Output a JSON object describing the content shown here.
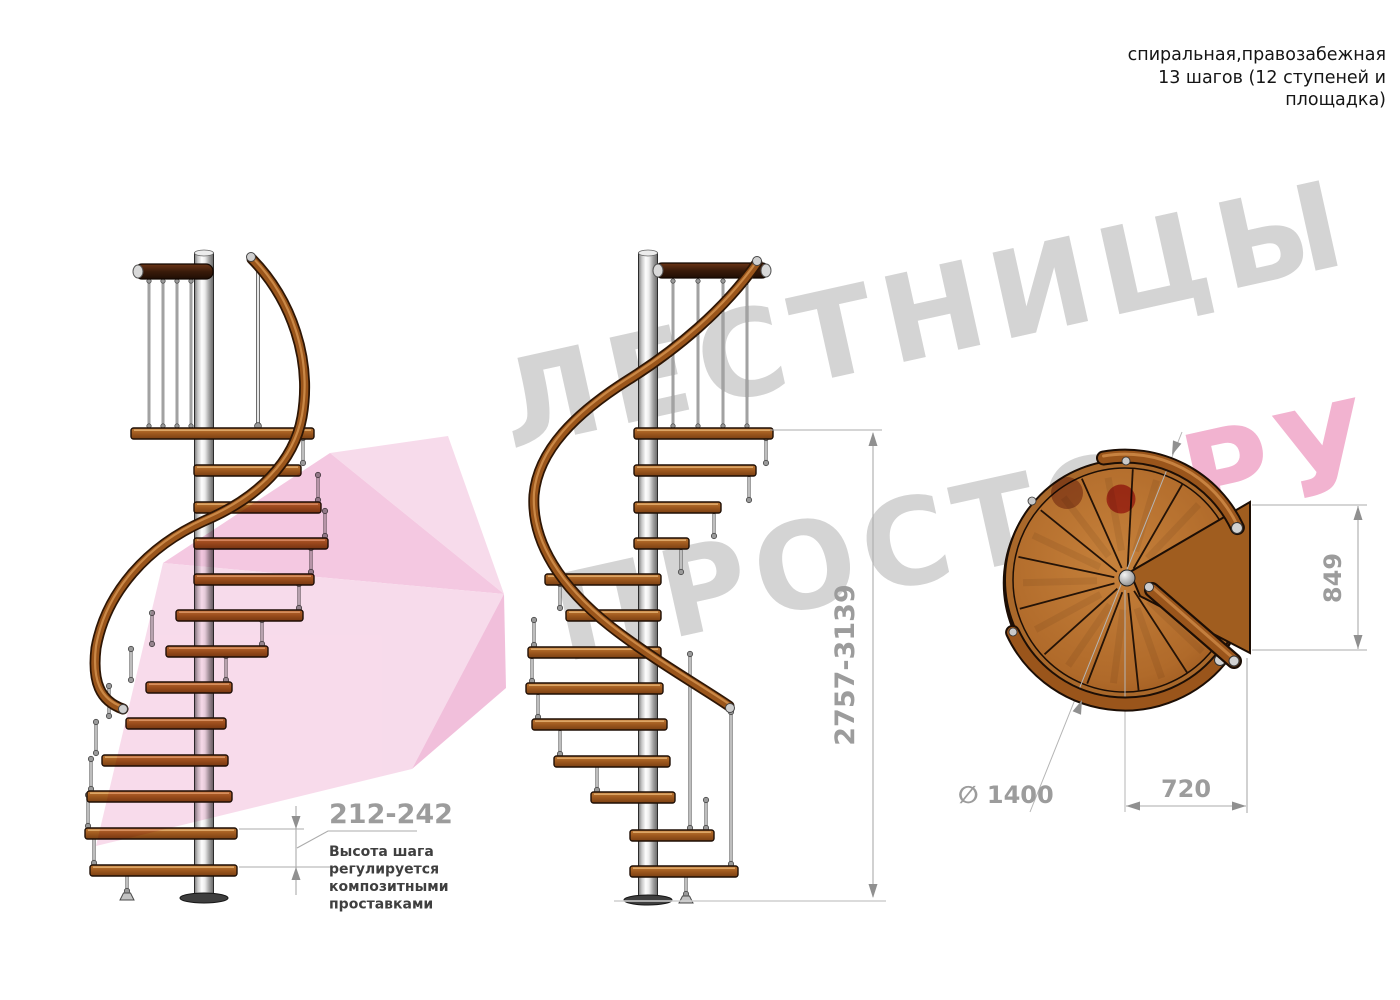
{
  "title_block": {
    "lines": [
      "спиральная,правозабежная",
      "13 шагов (12 ступеней и",
      "площадка)"
    ]
  },
  "watermark": {
    "line1": "ЛЕСТНИЦЫ",
    "line2": "ПРОСТО",
    "line2_suffix": "РУ",
    "text_color": "#d4d4d4",
    "suffix_color": "#f2b3d0",
    "dot_color": "#c5303e",
    "ribbon_pink": "#f3c3de"
  },
  "drawing": {
    "dimensions": {
      "step_height": {
        "value": "212-242",
        "note": [
          "Высота шага",
          "регулируется",
          "композитными",
          "проставками"
        ]
      },
      "total_height": {
        "value": "2757-3139"
      },
      "landing_depth": {
        "value": "849"
      },
      "landing_width": {
        "value": "720"
      },
      "outer_diameter": {
        "value": "∅ 1400"
      }
    },
    "colors": {
      "wood": "#a9682a",
      "wood_dark": "#7a3f12",
      "handrail": "#9a551b",
      "metal_pole": "#cfcfcf",
      "dimension_gray": "#9c9c9c",
      "note_text": "#3f3f3f"
    }
  }
}
